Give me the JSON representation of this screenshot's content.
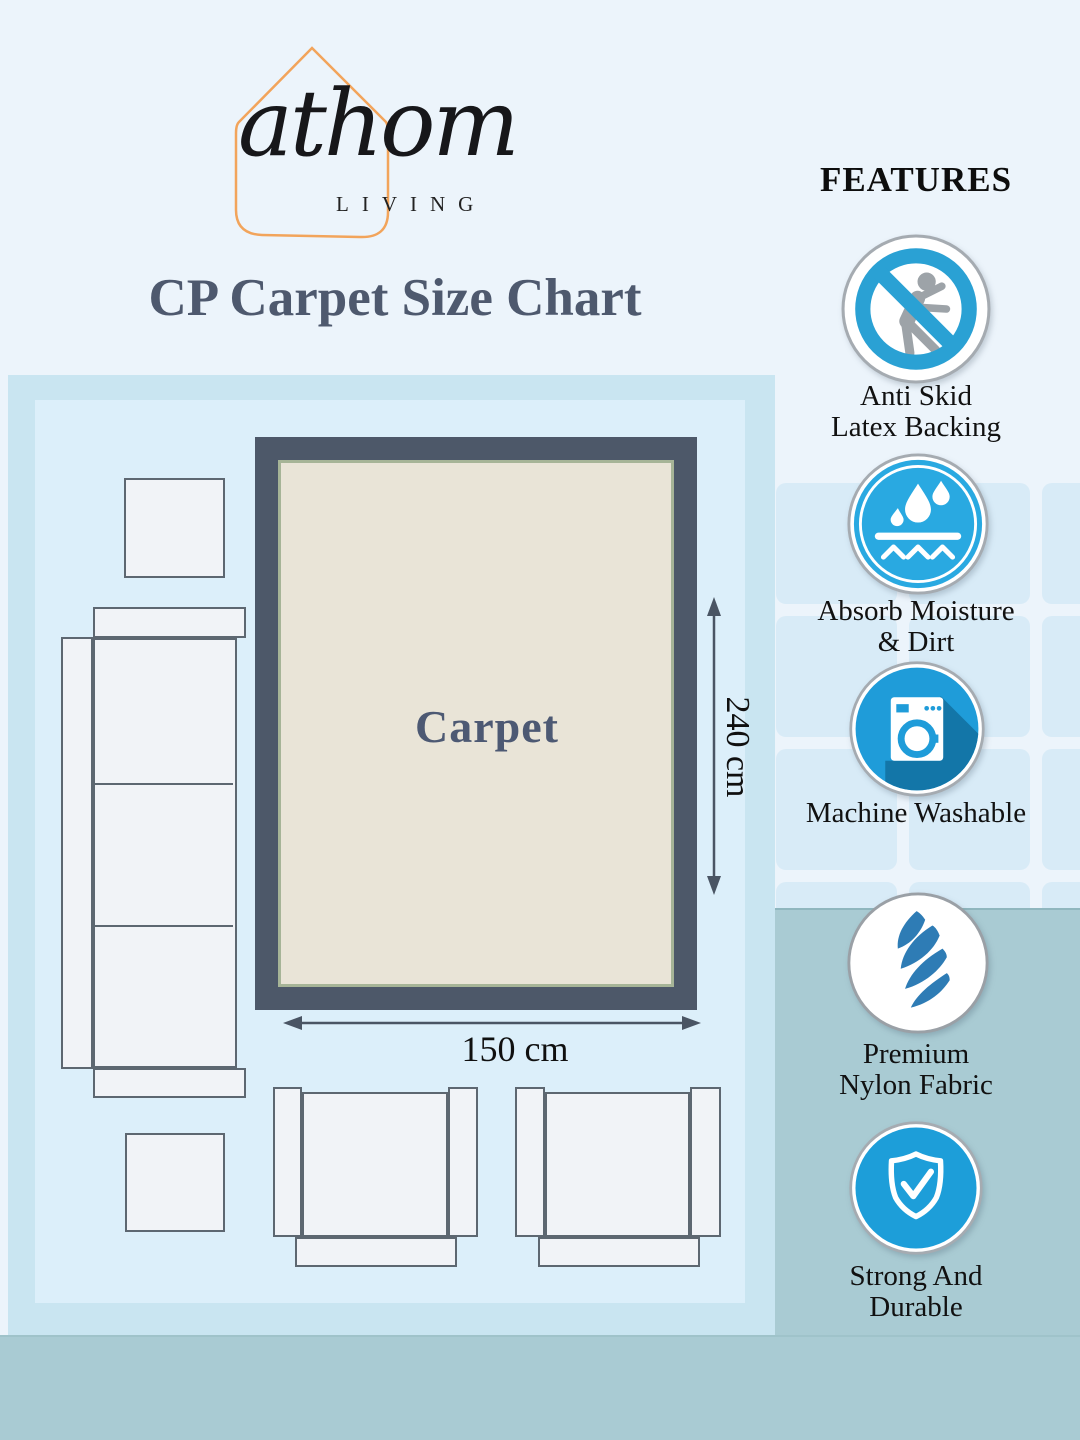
{
  "logo": {
    "brand": "athom",
    "sub": "LIVING"
  },
  "title": "CP Carpet Size Chart",
  "features": {
    "heading": "FEATURES",
    "items": [
      {
        "icon": "anti-skid-icon",
        "line1": "Anti Skid",
        "line2": "Latex Backing"
      },
      {
        "icon": "absorb-moisture-icon",
        "line1": "Absorb Moisture",
        "line2": "& Dirt"
      },
      {
        "icon": "machine-washable-icon",
        "line1": "Machine Washable",
        "line2": ""
      },
      {
        "icon": "premium-nylon-icon",
        "line1": "Premium",
        "line2": "Nylon Fabric"
      },
      {
        "icon": "strong-durable-icon",
        "line1": "Strong And",
        "line2": "Durable"
      }
    ]
  },
  "diagram": {
    "carpet_label": "Carpet",
    "height_label": "240 cm",
    "width_label": "150 cm",
    "carpet_width_cm": 150,
    "carpet_height_cm": 240
  },
  "colors": {
    "accent_blue": "#219fd6",
    "swirl_blue": "#2e7cb5",
    "dark_slate": "#4d5869",
    "carpet_beige": "#e9e4d7",
    "room_blue": "#dceffa",
    "panel_blue": "#c9e5f1",
    "band_blue_gray": "#a9cbd3",
    "tile_blue": "#d8ebf7",
    "logo_orange": "#f2a45b"
  }
}
